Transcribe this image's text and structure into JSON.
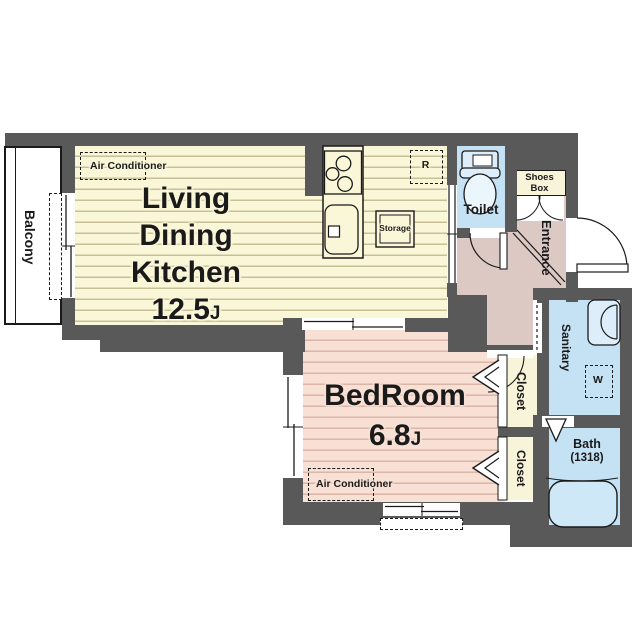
{
  "plan_type": "apartment-floor-plan",
  "rooms": {
    "ldk": {
      "line1": "Living",
      "line2": "Dining",
      "line3": "Kitchen",
      "size": "12.5",
      "unit": "J"
    },
    "bedroom": {
      "name": "BedRoom",
      "size": "6.8",
      "unit": "J"
    },
    "toilet": {
      "label": "Toilet"
    },
    "entrance": {
      "label": "Entrance"
    },
    "sanitary": {
      "label": "Sanitary"
    },
    "bath": {
      "label": "Bath",
      "dimension": "(1318)"
    },
    "closet_upper": {
      "label": "Closet"
    },
    "closet_lower": {
      "label": "Closet"
    },
    "balcony": {
      "label": "Balcony"
    },
    "shoes_box": {
      "line1": "Shoes",
      "line2": "Box"
    }
  },
  "equipment": {
    "ac_ldk": {
      "label": "Air Conditioner"
    },
    "ac_bedroom": {
      "label": "Air Conditioner"
    },
    "storage": {
      "label": "Storage"
    },
    "refrigerator": {
      "label": "R"
    },
    "washing_machine": {
      "label": "W"
    }
  },
  "colors": {
    "wall": "#595959",
    "ldk_floor": "#faf7d9",
    "ldk_stripe": "#c6bf98",
    "bedroom_floor": "#f8e0d5",
    "bedroom_stripe": "#d9b6a7",
    "hall_floor": "#ddc9c4",
    "wet_area": "#c4e2f3",
    "closet_floor": "#f8f4da",
    "fixture_fill": "#ddeefa",
    "line": "#1a1a1a"
  }
}
